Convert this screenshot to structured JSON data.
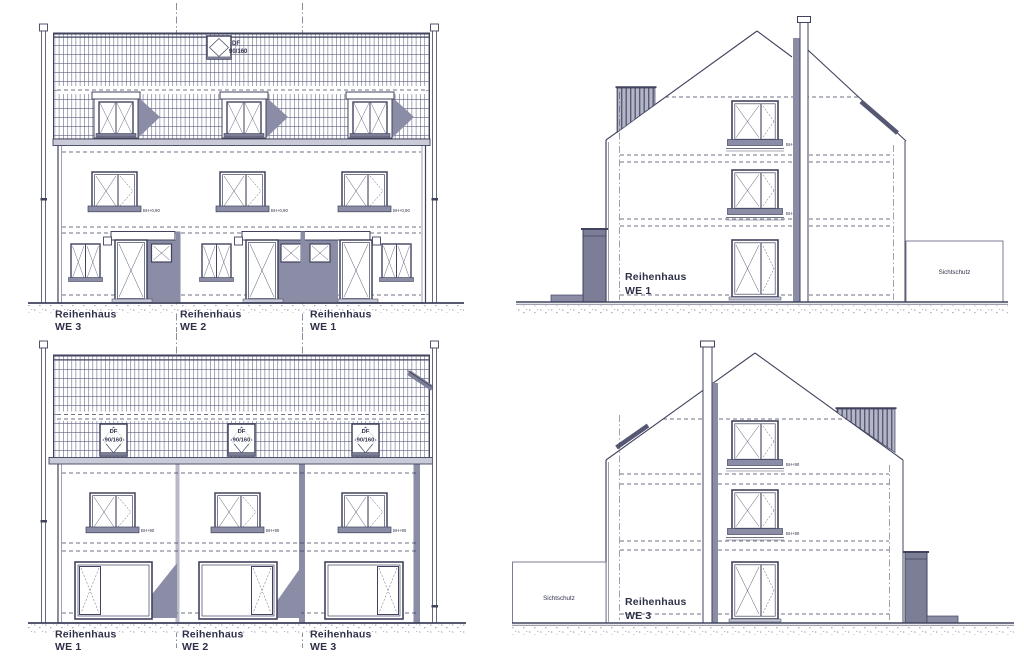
{
  "colors": {
    "line": "#41435e",
    "shadow_fill": "#8b8da6",
    "dark_fill": "#7c7e97",
    "text": "#2f3149",
    "background": "#ffffff"
  },
  "panels": {
    "front_elevation": {
      "units": [
        {
          "name": "Reihenhaus",
          "unit": "WE 3"
        },
        {
          "name": "Reihenhaus",
          "unit": "WE 2"
        },
        {
          "name": "Reihenhaus",
          "unit": "WE 1"
        }
      ],
      "roof_window": {
        "abbr": "DF",
        "size": "90/160"
      },
      "sill_label": "BH+0,90"
    },
    "side_elevation_we1": {
      "name": "Reihenhaus",
      "unit": "WE 1",
      "privacy_screen": "Sichtschutz",
      "sill_label": "BH+90"
    },
    "rear_elevation": {
      "units": [
        {
          "name": "Reihenhaus",
          "unit": "WE 1"
        },
        {
          "name": "Reihenhaus",
          "unit": "WE 2"
        },
        {
          "name": "Reihenhaus",
          "unit": "WE 3"
        }
      ],
      "roof_window": {
        "abbr": "DF",
        "size": "90/160"
      },
      "sill_label": "BH+90"
    },
    "side_elevation_we3": {
      "name": "Reihenhaus",
      "unit": "WE 3",
      "privacy_screen": "Sichtschutz",
      "sill_label": "BH+90"
    }
  }
}
